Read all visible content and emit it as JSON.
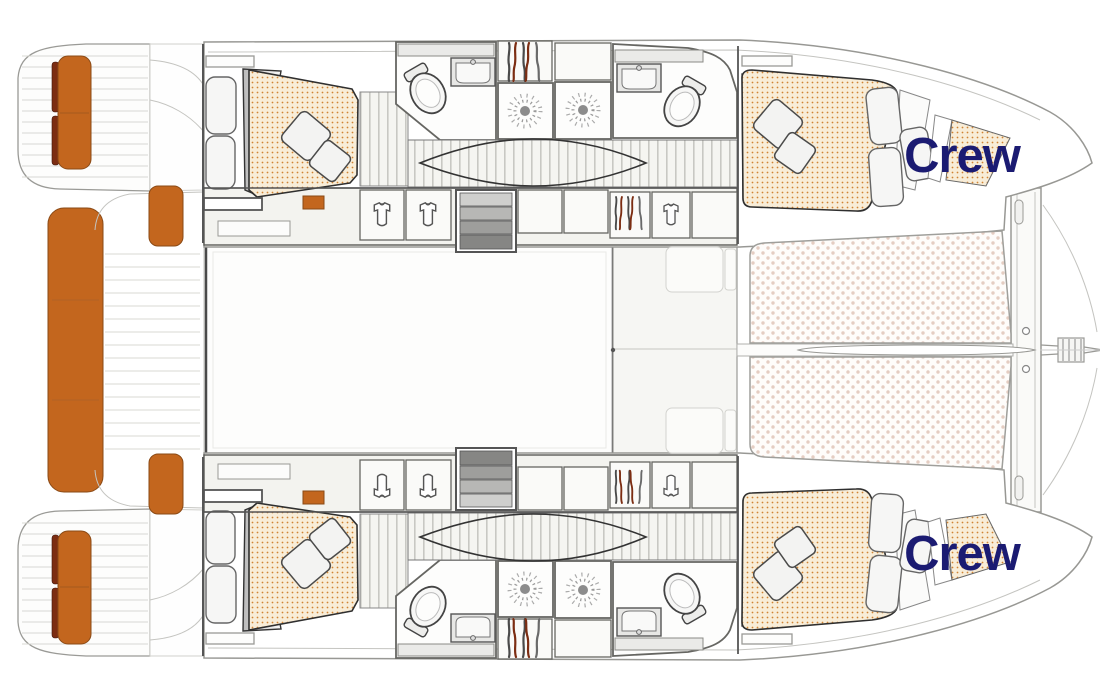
{
  "labels": {
    "crew_top": "Crew",
    "crew_bottom": "Crew"
  },
  "theme": {
    "accent-orange": "#c3661e",
    "dark-red": "#7c2d12",
    "bed-bg": "#f8edd8",
    "bed-dot": "#d08434",
    "tramp-dot": "#e4cdc2",
    "crew-navy": "#1b1b72",
    "wall-gray": "#555555",
    "outline-gray": "#9a9a96"
  },
  "icons": {
    "toilet-icon": "rotated oval bowl with cistern",
    "sink-icon": "rectangle with rounded basin and faucet dot",
    "shower-icon": "sunburst drain",
    "wardrobe-shirt-icon": "folded shirt glyph",
    "hanging-garments-icon": "vertical garment strokes, gray and red",
    "companionway-steps-icon": "gray gradient treads",
    "bed-mattress": "cream quilt with orange dot pattern",
    "trampoline-mesh": "white netting with dot pattern"
  }
}
